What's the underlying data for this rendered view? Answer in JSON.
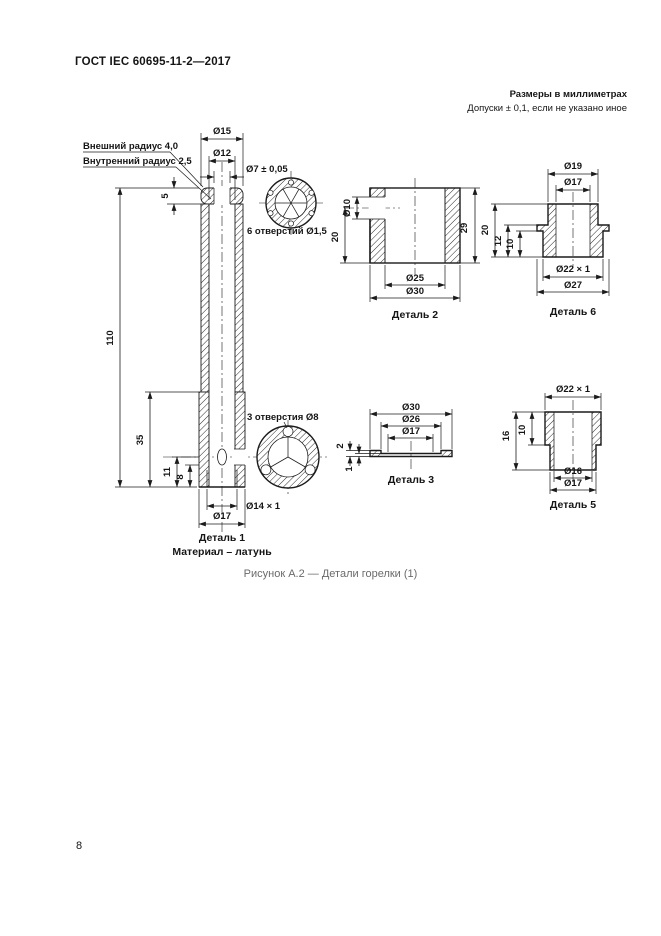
{
  "page": {
    "header_title": "ГОСТ IEC 60695-11-2—2017",
    "units_note": "Размеры в миллиметрах",
    "tolerance_note": "Допуски ± 0,1, если не указано иное",
    "figure_caption": "Рисунок А.2 — Детали горелки (1)",
    "page_number": "8"
  },
  "part1": {
    "name": "Деталь 1",
    "material": "Материал – латунь",
    "callout_outer_radius": "Внешний радиус 4,0",
    "callout_inner_radius": "Внутренний радиус 2,5",
    "holes_top_note": "6 отверстий Ø1,5",
    "holes_side_note": "3 отверстия Ø8",
    "dims": {
      "d15": "Ø15",
      "d12": "Ø12",
      "d7": "Ø7 ± 0,05",
      "h5": "5",
      "h110": "110",
      "h35": "35",
      "h11": "11",
      "h8": "8",
      "d14": "Ø14 × 1",
      "d17": "Ø17"
    }
  },
  "part2": {
    "name": "Деталь 2",
    "dims": {
      "d10": "Ø10",
      "h20": "20",
      "h29": "29",
      "d25": "Ø25",
      "d30": "Ø30"
    }
  },
  "part3": {
    "name": "Деталь 3",
    "dims": {
      "d30": "Ø30",
      "d26": "Ø26",
      "d17": "Ø17",
      "t2": "2",
      "t1": "1"
    }
  },
  "part5": {
    "name": "Деталь 5",
    "dims": {
      "d22": "Ø22 × 1",
      "h16": "16",
      "h10": "10",
      "d16": "Ø16",
      "d17": "Ø17"
    }
  },
  "part6": {
    "name": "Деталь 6",
    "dims": {
      "d19": "Ø19",
      "d17": "Ø17",
      "h20": "20",
      "h12": "12",
      "h10": "10",
      "d22": "Ø22 × 1",
      "d27": "Ø27"
    }
  }
}
